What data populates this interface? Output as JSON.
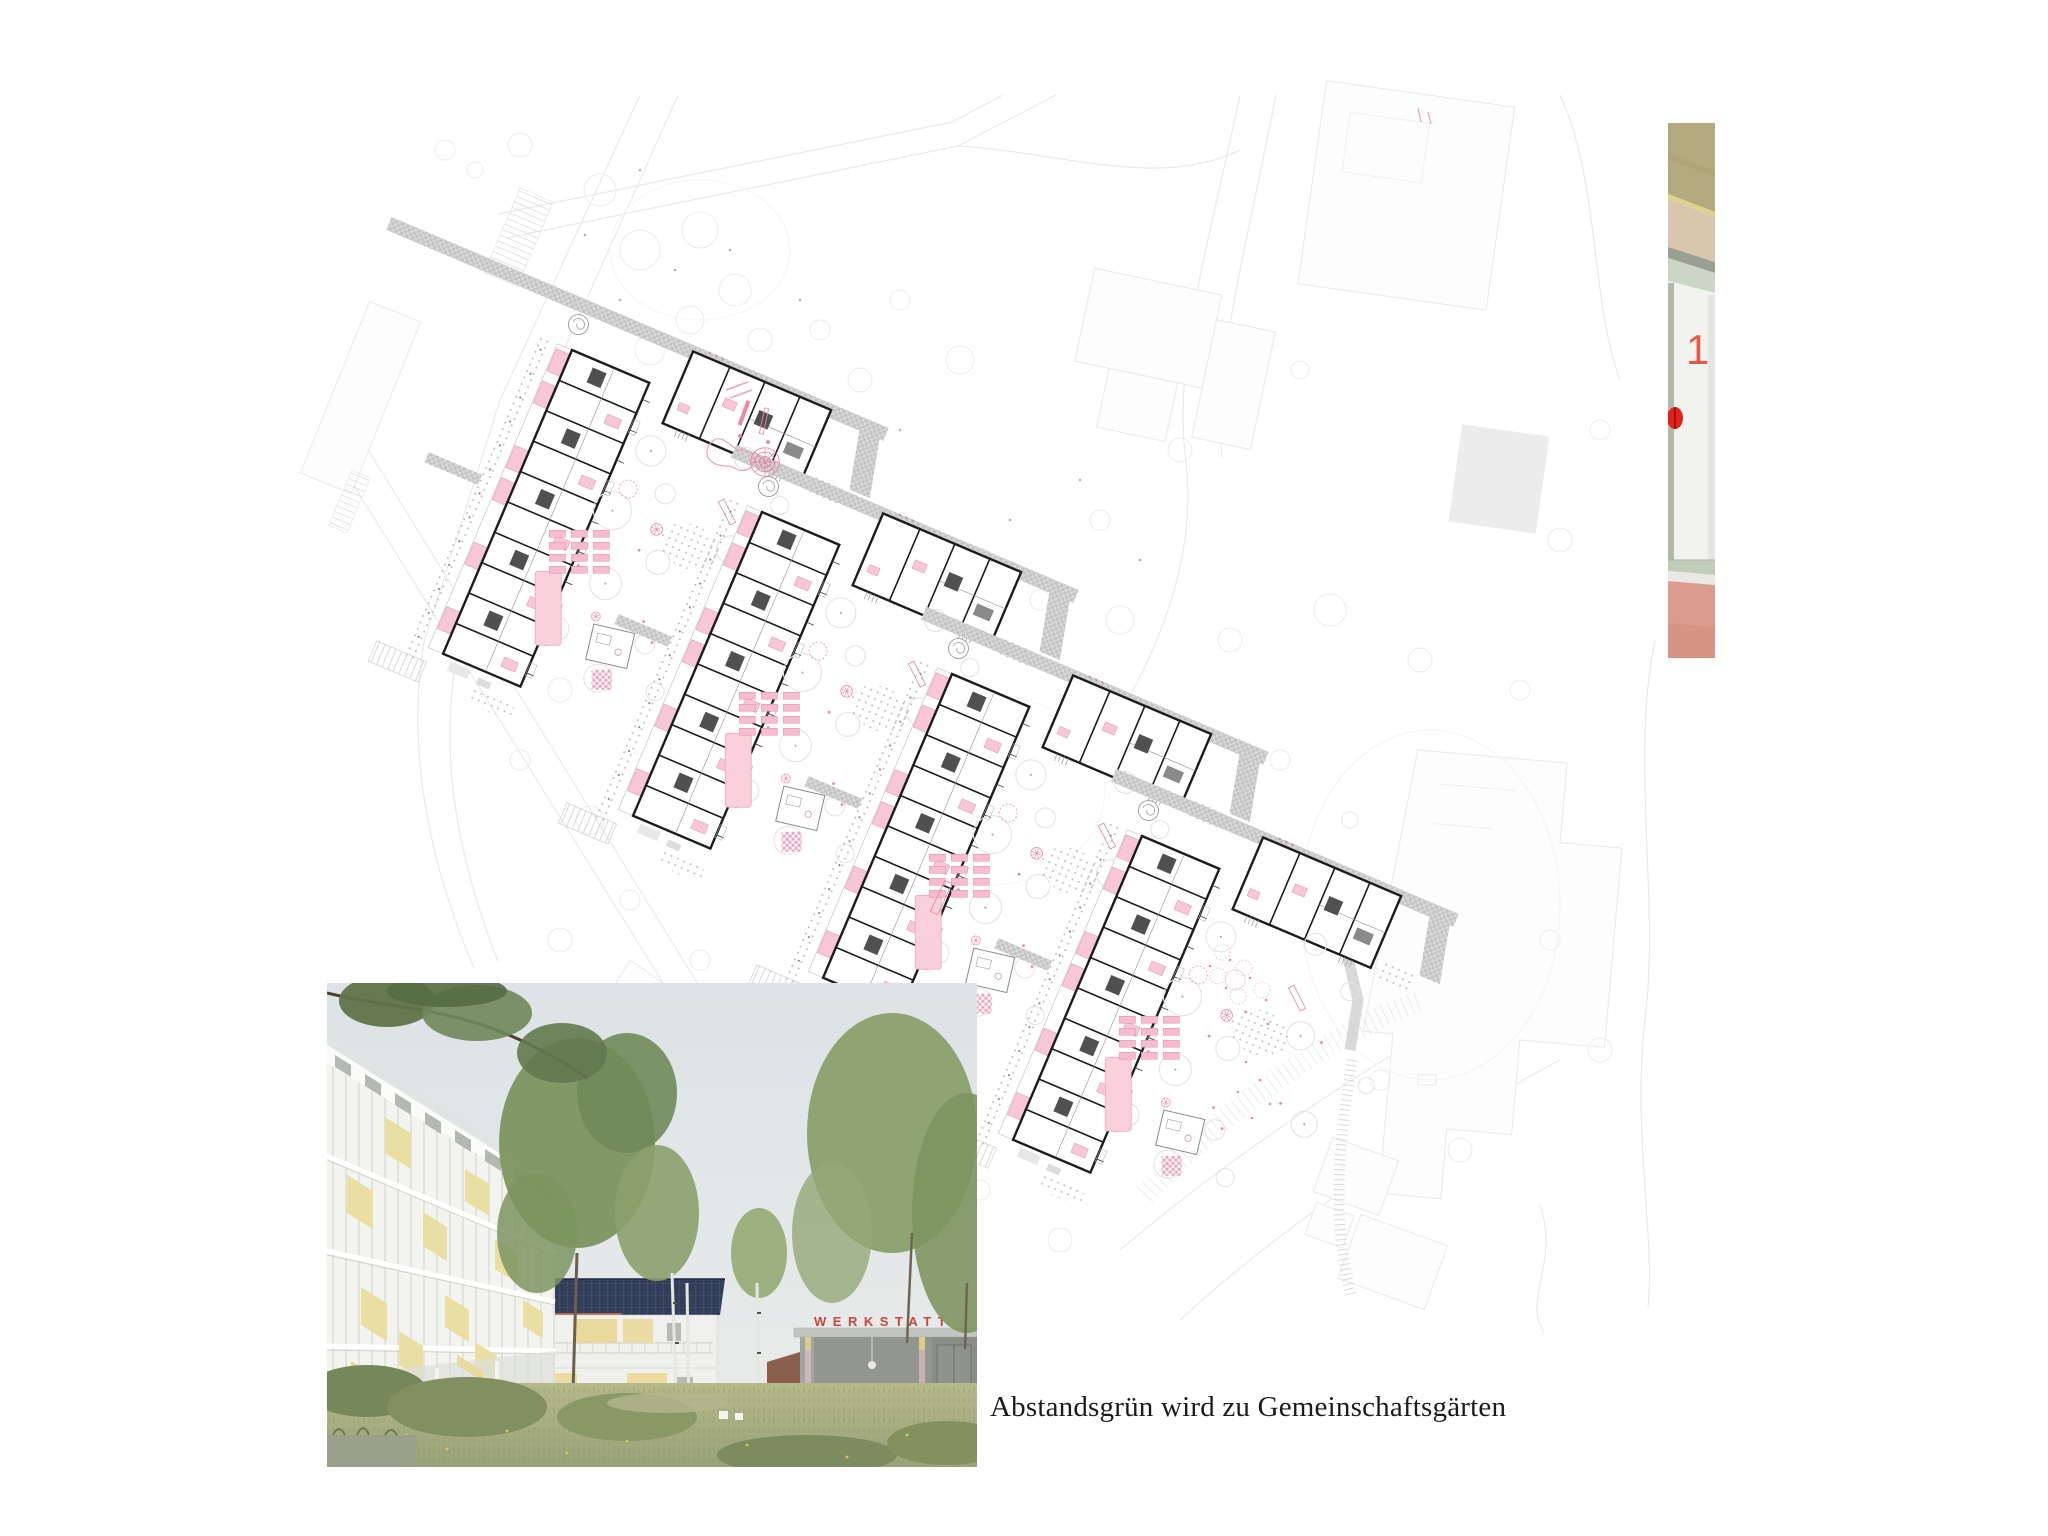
{
  "caption": "Abstandsgrün wird zu Gemeinschaftsgärten",
  "rendering": {
    "werkstatt_sign": "WERKSTATT"
  },
  "door_detail": {
    "number": "1"
  },
  "colors": {
    "accent_pink": "#f7c7d7",
    "accent_pink_stroke": "#e08fae",
    "plan_ink": "#1c1c1c",
    "path_gray": "#cfcfcf",
    "werkstatt_red": "#c8473a",
    "door_number_red": "#e25a4c",
    "door_dot_red": "#e32119",
    "floor_salmon": "#db9b8f",
    "ceiling_khaki": "#b4aa80",
    "awning_yellow": "#e9d99c",
    "solar_navy": "#333e59",
    "sky": "#dde3e6",
    "meadow_green": "#a8ad83"
  }
}
